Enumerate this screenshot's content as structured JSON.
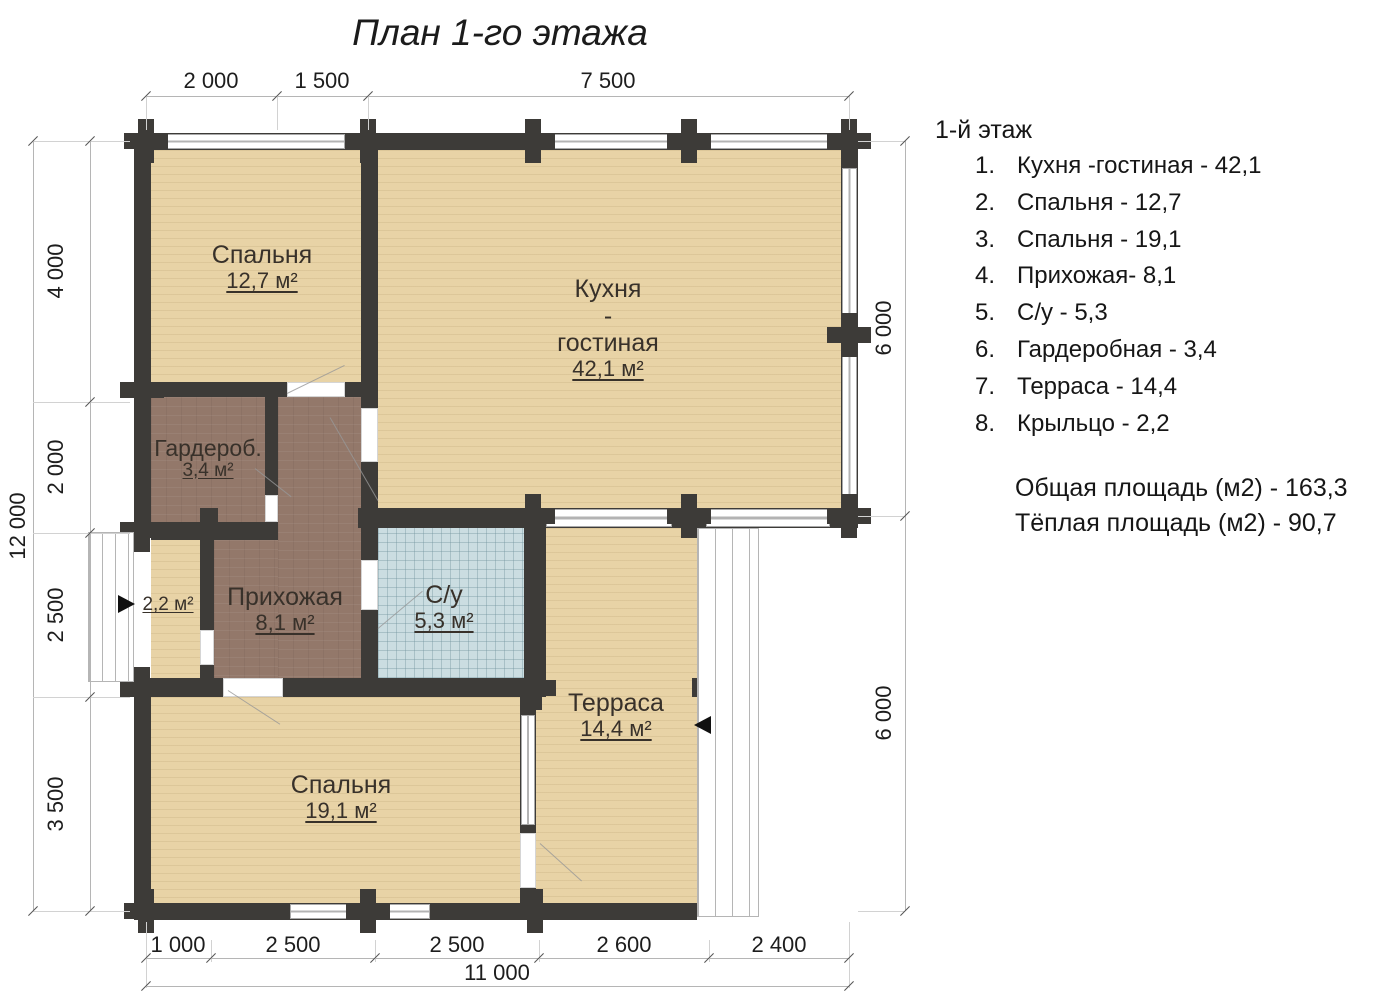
{
  "title": "План 1-го этажа",
  "rooms": {
    "bedroom1": {
      "name": "Спальня",
      "area": "12,7 м²"
    },
    "kitchen": {
      "name_line1": "Кухня",
      "name_line2": "-",
      "name_line3": "гостиная",
      "area": "42,1 м²"
    },
    "wardrobe": {
      "name": "Гардероб.",
      "area": "3,4 м²"
    },
    "hallway": {
      "name": "Прихожая",
      "area": "8,1 м²"
    },
    "bathroom": {
      "name": "С/у",
      "area": "5,3 м²"
    },
    "terrace": {
      "name": "Терраса",
      "area": "14,4 м²"
    },
    "bedroom2": {
      "name": "Спальня",
      "area": "19,1 м²"
    },
    "porch": {
      "area": "2,2 м²"
    }
  },
  "dimensions": {
    "top": [
      "2 000",
      "1 500",
      "7 500"
    ],
    "left_segments": [
      "4 000",
      "2 000",
      "2 500",
      "3 500"
    ],
    "left_total": "12 000",
    "right_segments": [
      "6 000",
      "6 000"
    ],
    "bottom_segments": [
      "1 000",
      "2 500",
      "2 500",
      "2 600",
      "2 400"
    ],
    "bottom_total": "11 000"
  },
  "legend": {
    "heading": "1-й этаж",
    "items": [
      {
        "num": "1.",
        "text": "Кухня -гостиная - 42,1"
      },
      {
        "num": "2.",
        "text": "Спальня - 12,7"
      },
      {
        "num": "3.",
        "text": "Спальня - 19,1"
      },
      {
        "num": "4.",
        "text": "Прихожая- 8,1"
      },
      {
        "num": "5.",
        "text": "С/у - 5,3"
      },
      {
        "num": "6.",
        "text": "Гардеробная - 3,4"
      },
      {
        "num": "7.",
        "text": "Терраса - 14,4"
      },
      {
        "num": "8.",
        "text": "Крыльцо - 2,2"
      }
    ],
    "total_area": "Общая площадь (м2) - 163,3",
    "warm_area": "Тёплая площадь (м2) - 90,7"
  },
  "colors": {
    "wall": "#3d3b38",
    "wood_floor": "#e8d3a6",
    "brown_floor": "#93786a",
    "tile_floor": "#cbdde1"
  }
}
